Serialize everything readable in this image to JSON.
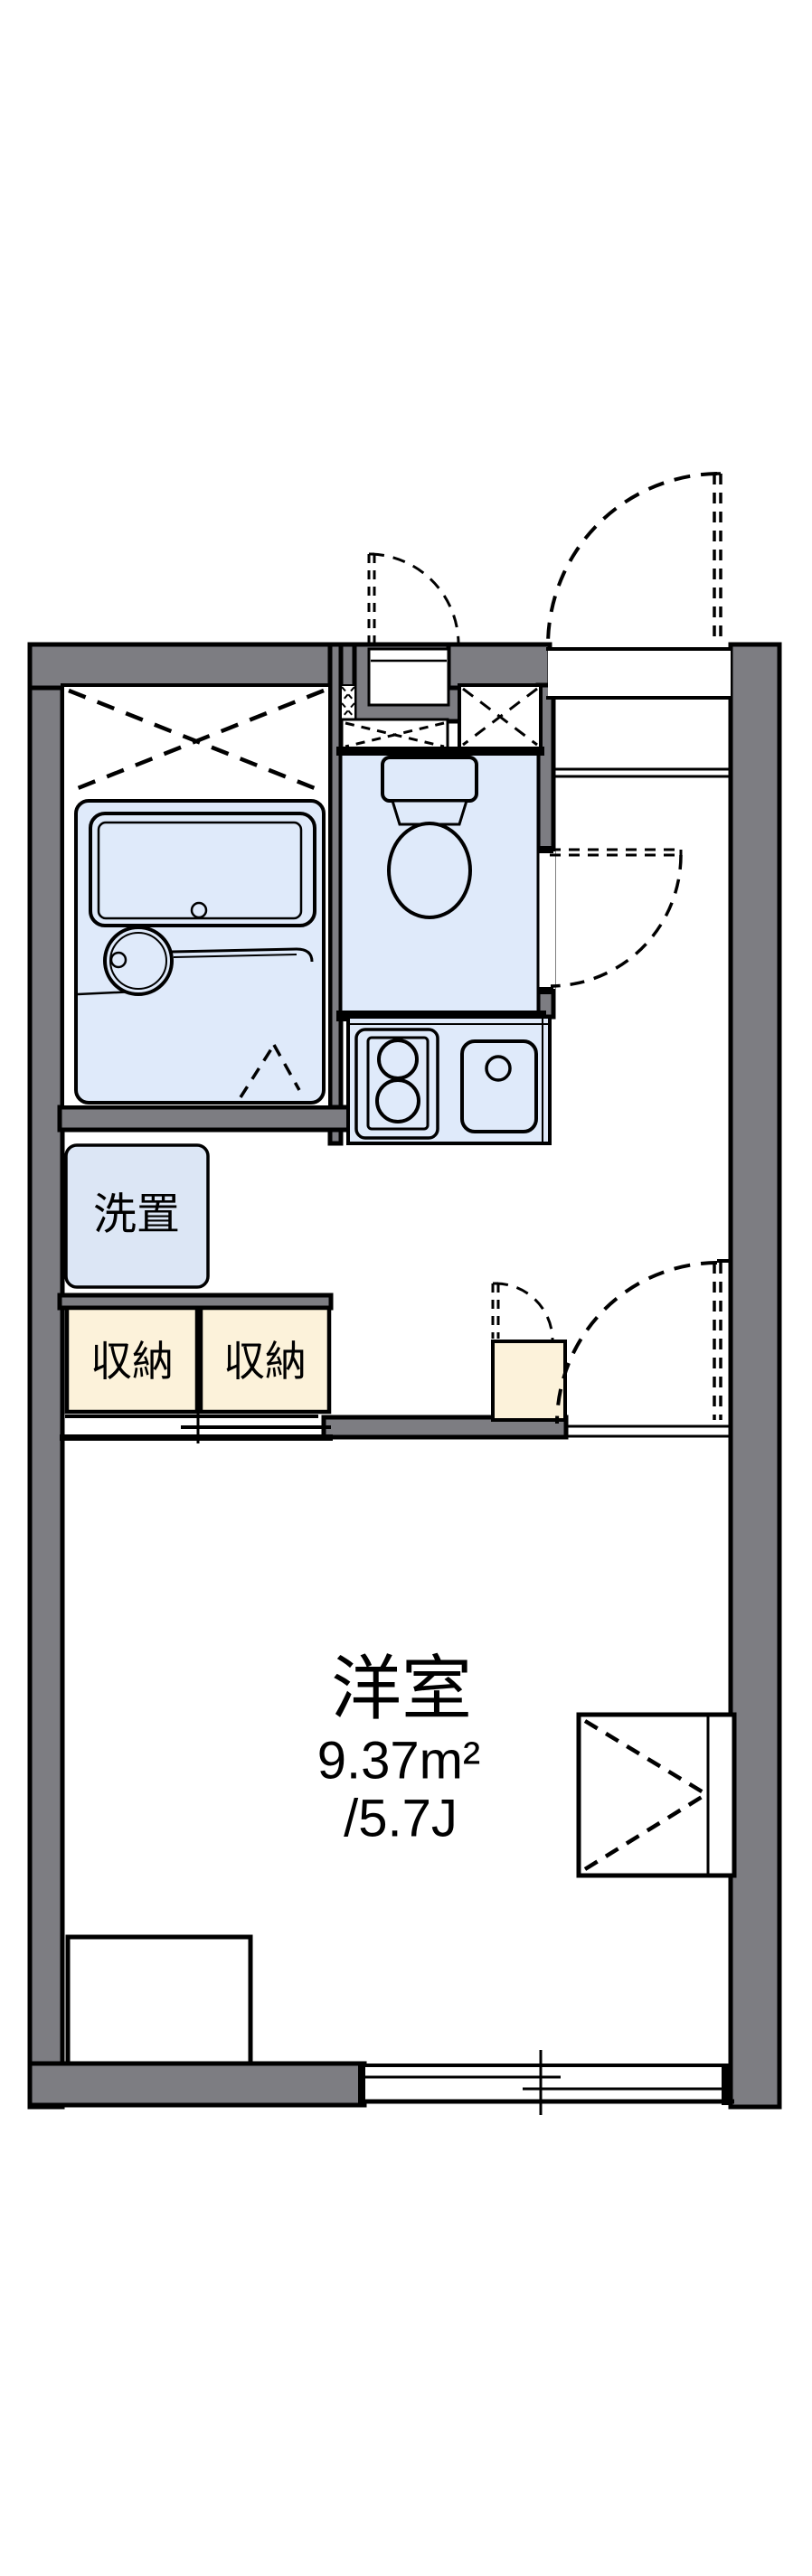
{
  "floor_plan": {
    "labels": {
      "washer_space": "洗置",
      "storage_1": "収納",
      "storage_2": "収納",
      "main_room_name": "洋室",
      "main_room_area_sqm": "9.37m²",
      "main_room_area_jo": "/5.7J"
    },
    "colors": {
      "wall": "#7d7d82",
      "water_fixture_blue": "#dfeafa",
      "washer_box_blue": "#dce6f5",
      "storage_cream": "#fcf2da",
      "line": "#000000",
      "background": "#ffffff"
    }
  }
}
